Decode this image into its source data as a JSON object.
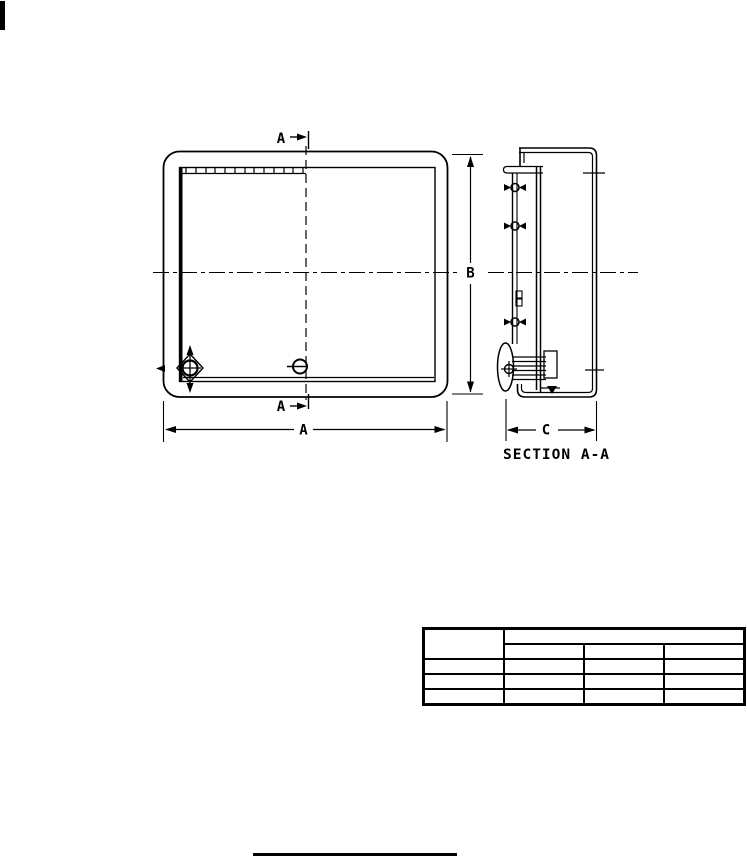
{
  "page": {
    "background": "#ffffff",
    "ink": "#000000"
  },
  "figure": {
    "front_view": {
      "cut_label_top": "A",
      "cut_label_bottom": "A",
      "width_dim": "A",
      "height_dim": "B"
    },
    "section_view": {
      "caption": "SECTION A-A",
      "depth_dim": "C"
    }
  },
  "table": {
    "corner_cell": "",
    "group_header": "",
    "sub_headers": [
      "",
      "",
      ""
    ],
    "rows": [
      [
        "",
        "",
        "",
        ""
      ],
      [
        "",
        "",
        "",
        ""
      ],
      [
        "",
        "",
        "",
        ""
      ]
    ]
  }
}
